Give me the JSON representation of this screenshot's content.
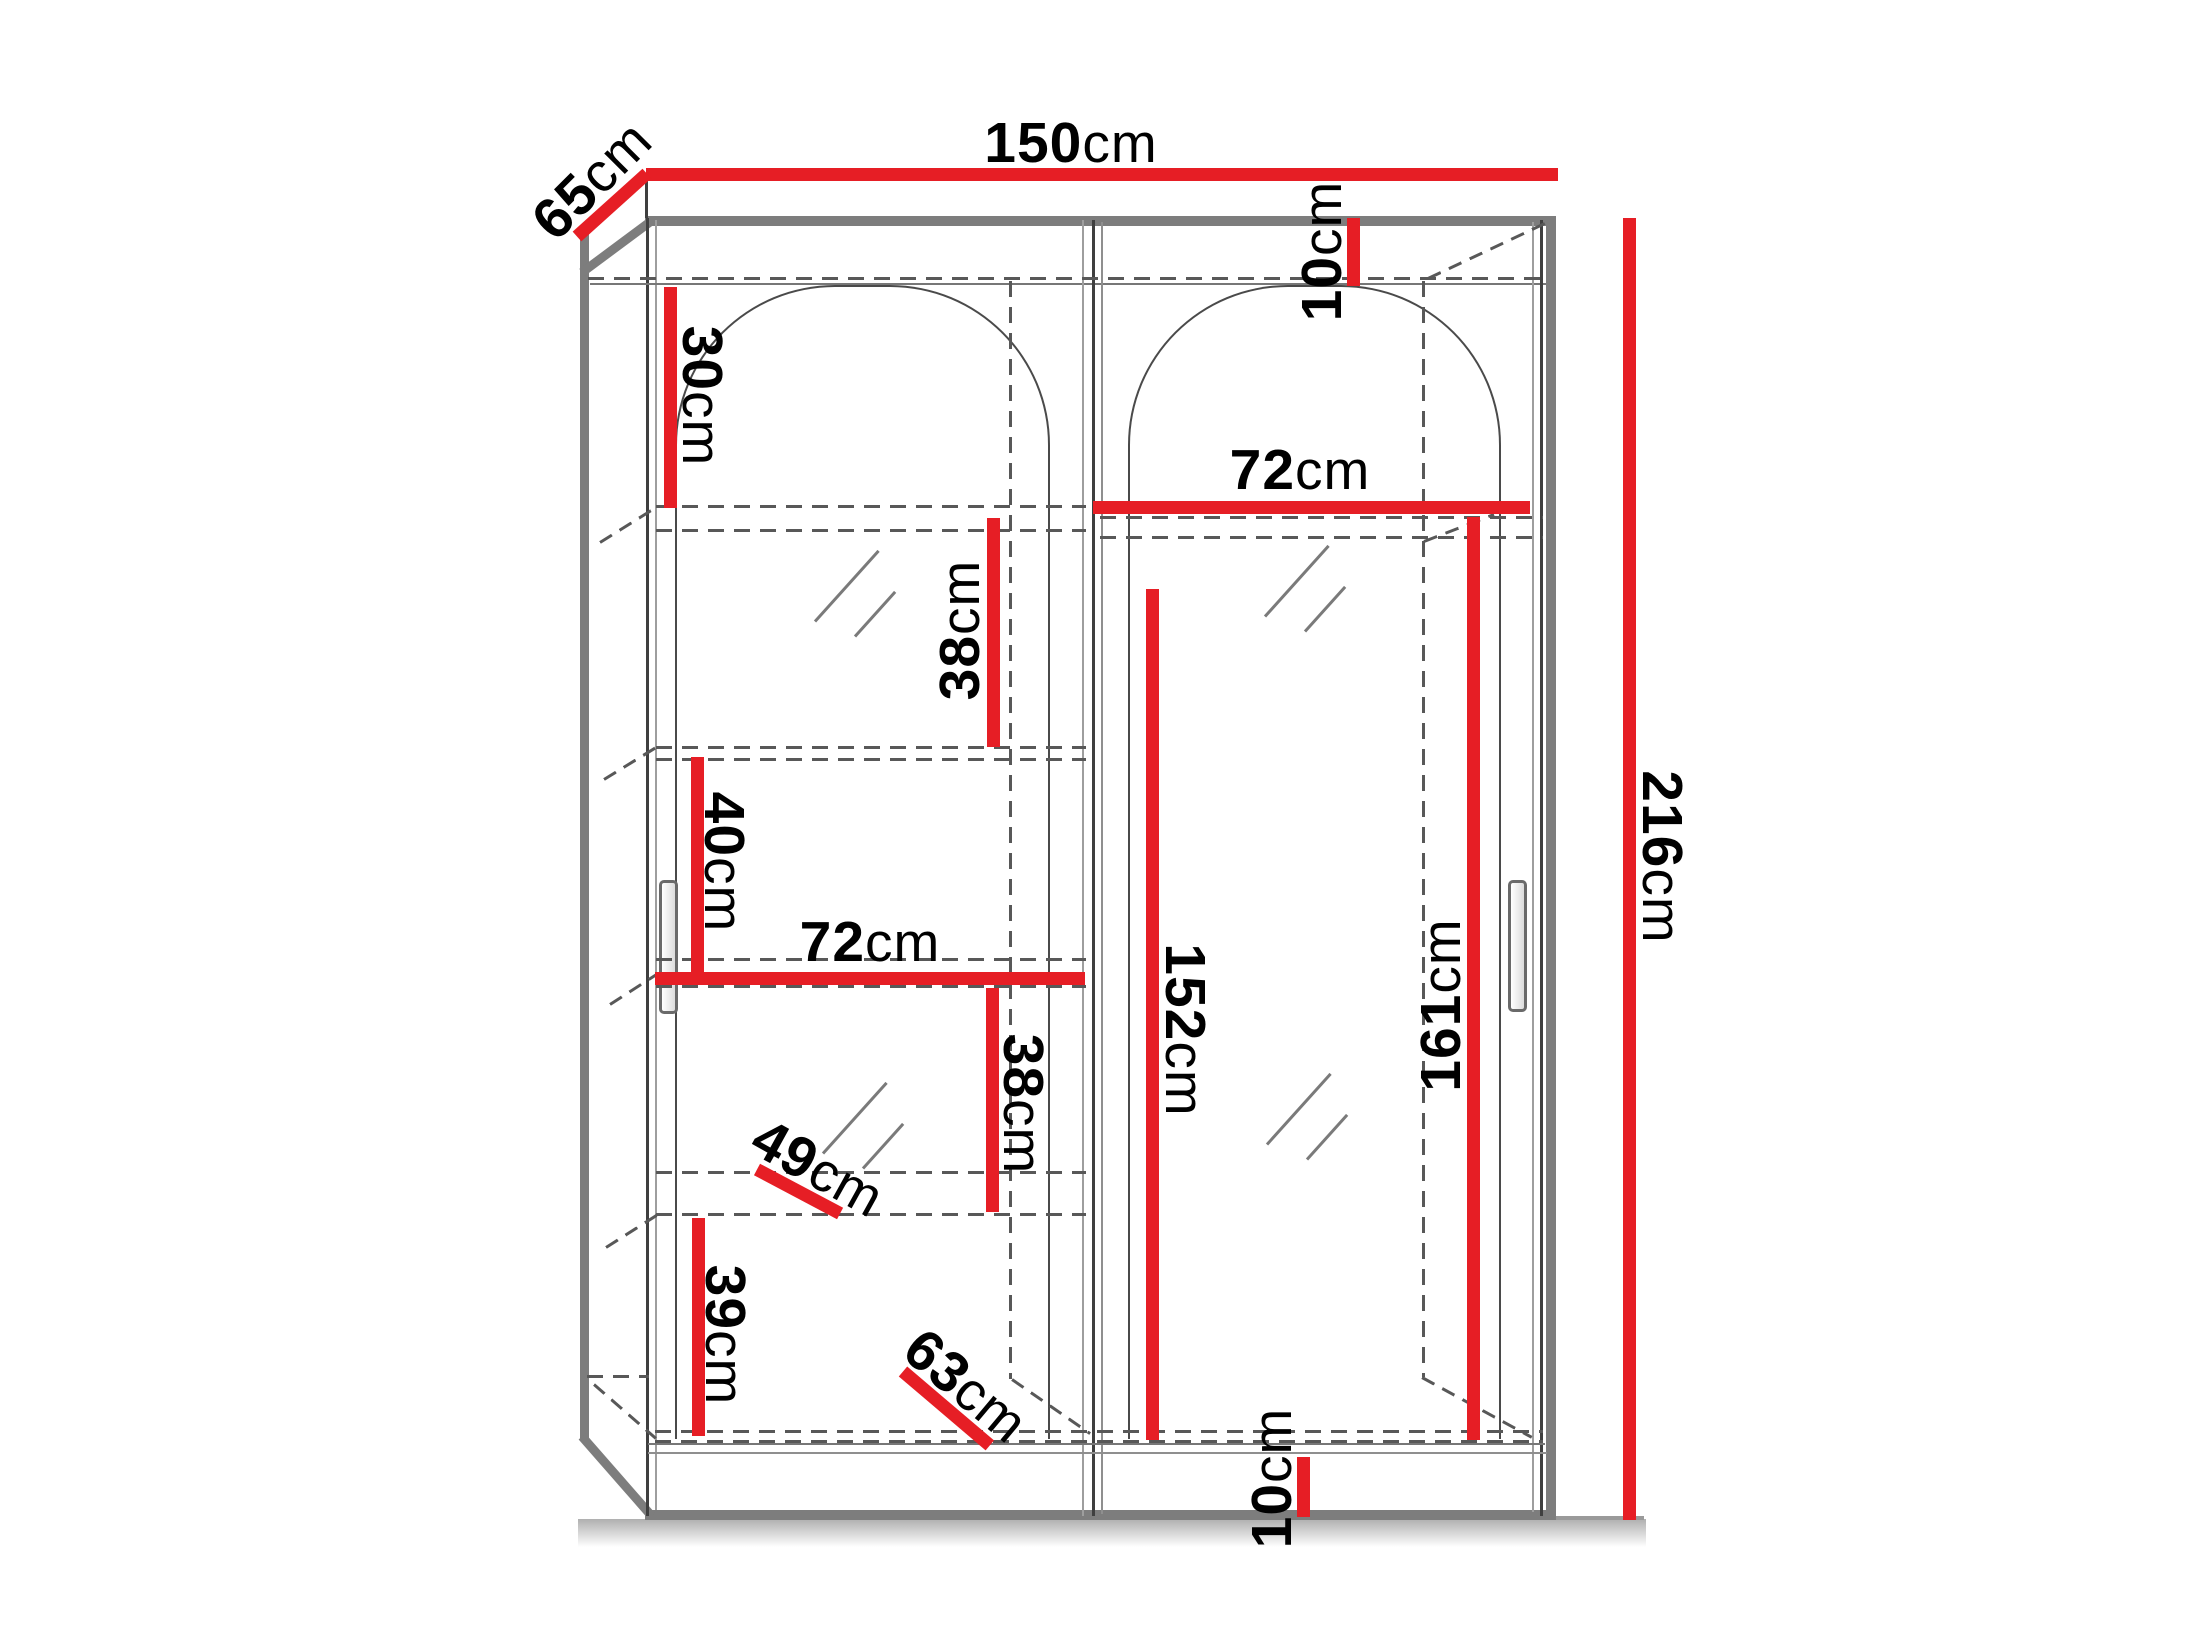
{
  "diagram": {
    "type": "wardrobe-dimension-drawing",
    "dimension_color": "#e61e25",
    "outline_color": "#7d7d7d",
    "labels": {
      "width_top": {
        "value": "150",
        "unit": "cm"
      },
      "depth_top": {
        "value": "65",
        "unit": "cm"
      },
      "gap_top": {
        "value": "10",
        "unit": "cm"
      },
      "section_30": {
        "value": "30",
        "unit": "cm"
      },
      "shelf_72_right": {
        "value": "72",
        "unit": "cm"
      },
      "section_38_upper": {
        "value": "38",
        "unit": "cm"
      },
      "section_40": {
        "value": "40",
        "unit": "cm"
      },
      "shelf_72_left": {
        "value": "72",
        "unit": "cm"
      },
      "section_38_lower": {
        "value": "38",
        "unit": "cm"
      },
      "depth_49": {
        "value": "49",
        "unit": "cm"
      },
      "section_39": {
        "value": "39",
        "unit": "cm"
      },
      "depth_63": {
        "value": "63",
        "unit": "cm"
      },
      "hanging_152": {
        "value": "152",
        "unit": "cm"
      },
      "hanging_161": {
        "value": "161",
        "unit": "cm"
      },
      "height_total": {
        "value": "216",
        "unit": "cm"
      },
      "gap_bottom": {
        "value": "10",
        "unit": "cm"
      }
    }
  }
}
